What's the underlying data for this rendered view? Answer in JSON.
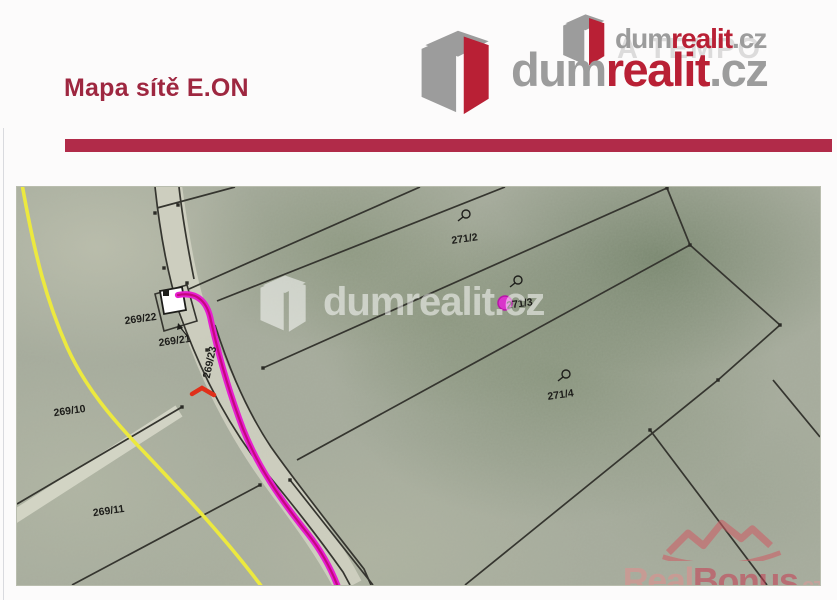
{
  "header": {
    "title": "Mapa sítě E.ON",
    "logo_main": {
      "dum": "dum",
      "realit": "realit",
      "tld": ".cz"
    },
    "logo_small": {
      "dum": "dum",
      "realit": "realit",
      "tld": ".cz",
      "ghost": "A TEMPO"
    }
  },
  "map": {
    "labels": [
      {
        "text": "271/2"
      },
      {
        "text": "271/3"
      },
      {
        "text": "271/4"
      },
      {
        "text": "269/10"
      },
      {
        "text": "269/11"
      },
      {
        "text": "269/22"
      },
      {
        "text": "269/21"
      },
      {
        "text": "269/23"
      }
    ],
    "watermark_center": {
      "dum": "dum",
      "realit": "realit",
      "tld": ".cz"
    },
    "watermark_bottom": {
      "real": "Real",
      "bonus": "Bonus",
      "tld": ".cz"
    },
    "colors": {
      "network_line": "#e61fd0",
      "network_line_core": "#c4087e",
      "secondary_line": "#ece93f",
      "red_mark": "#e0301a",
      "parcel_line": "#35352f",
      "accent_bar": "#b12b49",
      "logo_red": "#b92035",
      "logo_gray": "#9c9c9c"
    }
  }
}
